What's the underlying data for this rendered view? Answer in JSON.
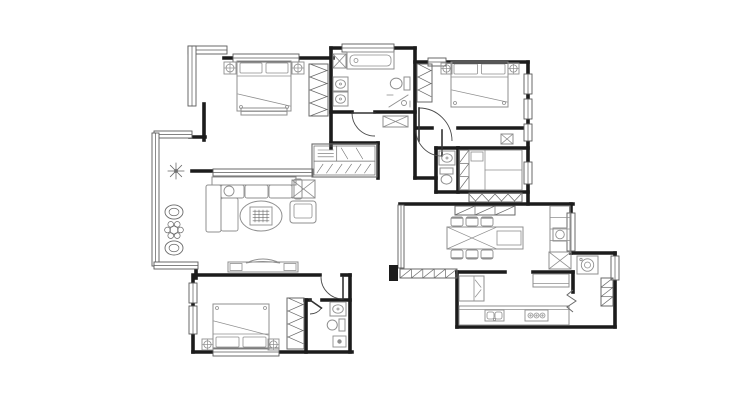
{
  "meta": {
    "canvas": {
      "w": 740,
      "h": 400
    }
  },
  "colors": {
    "bg": "#ffffff",
    "wall": "#1c1c1c",
    "furniture": "#8f8f8f",
    "thin": "#6a6a6a",
    "door": "#4a4a4a",
    "window": "#5a5a5a"
  },
  "walls": [
    [
      224,
      58,
      333,
      58
    ],
    [
      331,
      48,
      415,
      48
    ],
    [
      331,
      48,
      331,
      148
    ],
    [
      415,
      48,
      415,
      178
    ],
    [
      415,
      62,
      528,
      62
    ],
    [
      528,
      62,
      528,
      204
    ],
    [
      331,
      112,
      352,
      112
    ],
    [
      375,
      112,
      415,
      112
    ],
    [
      417,
      128,
      432,
      128
    ],
    [
      458,
      128,
      528,
      128
    ],
    [
      415,
      178,
      436,
      178
    ],
    [
      436,
      148,
      436,
      192
    ],
    [
      436,
      148,
      458,
      148
    ],
    [
      458,
      148,
      458,
      192
    ],
    [
      458,
      148,
      528,
      148
    ],
    [
      436,
      192,
      528,
      192
    ],
    [
      400,
      204,
      573,
      204
    ],
    [
      571,
      204,
      571,
      253
    ],
    [
      573,
      253,
      615,
      253
    ],
    [
      615,
      253,
      615,
      327
    ],
    [
      457,
      327,
      615,
      327
    ],
    [
      457,
      272,
      457,
      327
    ],
    [
      457,
      272,
      505,
      272
    ],
    [
      533,
      272,
      573,
      272
    ],
    [
      573,
      272,
      573,
      292
    ],
    [
      196,
      275,
      320,
      275
    ],
    [
      342,
      275,
      350,
      275
    ],
    [
      350,
      275,
      350,
      352
    ],
    [
      193,
      275,
      193,
      352
    ],
    [
      193,
      352,
      352,
      352
    ],
    [
      305,
      300,
      310,
      300
    ],
    [
      322,
      300,
      350,
      300
    ],
    [
      306,
      300,
      306,
      352
    ],
    [
      331,
      143,
      378,
      143
    ],
    [
      378,
      143,
      378,
      178
    ],
    [
      190,
      137,
      205,
      137
    ],
    [
      204,
      104,
      204,
      140
    ],
    [
      192,
      171,
      213,
      171
    ],
    [
      196,
      264,
      196,
      278
    ]
  ],
  "windows": [
    [
      233,
      54,
      66,
      8
    ],
    [
      342,
      44,
      52,
      8
    ],
    [
      428,
      58,
      18,
      8
    ],
    [
      524,
      74,
      8,
      20
    ],
    [
      524,
      99,
      8,
      20
    ],
    [
      524,
      124,
      8,
      17
    ],
    [
      524,
      162,
      8,
      22
    ],
    [
      567,
      213,
      8,
      38
    ],
    [
      611,
      256,
      8,
      24
    ],
    [
      188,
      46,
      39,
      8
    ],
    [
      188,
      46,
      8,
      60
    ],
    [
      154,
      131,
      38,
      7
    ],
    [
      152,
      133,
      7,
      133
    ],
    [
      154,
      262,
      44,
      7
    ],
    [
      189,
      283,
      8,
      20
    ],
    [
      189,
      306,
      8,
      28
    ],
    [
      213,
      348,
      66,
      8
    ],
    [
      213,
      169,
      100,
      7
    ],
    [
      398,
      205,
      6,
      63
    ]
  ],
  "doors": [
    {
      "name": "bathroom-door",
      "hx": 375,
      "hy": 113,
      "r": 23,
      "a1": 90,
      "a2": 180,
      "leaf": 180
    },
    {
      "name": "entry-door",
      "hx": 419,
      "hy": 141,
      "r": 33,
      "a1": 270,
      "a2": 360,
      "leaf": 270
    },
    {
      "name": "bedroom2-door",
      "hx": 442,
      "hy": 130,
      "r": 26,
      "a1": 90,
      "a2": 180,
      "leaf": 90
    },
    {
      "name": "bedroom3-door",
      "hx": 343,
      "hy": 277,
      "r": 22,
      "a1": 90,
      "a2": 180,
      "leaf": 90
    },
    {
      "name": "bath3-door",
      "hx": 310,
      "hy": 300,
      "r": 14,
      "a1": 35,
      "a2": 90,
      "leaf": 35
    }
  ],
  "furniture": [
    {
      "name": "master-bed",
      "type": "bed",
      "x": 237,
      "y": 61,
      "w": 54,
      "h": 50,
      "head": "top"
    },
    {
      "name": "master-nightstand-left",
      "type": "lamp",
      "x": 224,
      "y": 62,
      "s": 12
    },
    {
      "name": "master-nightstand-right",
      "type": "lamp",
      "x": 292,
      "y": 62,
      "s": 12
    },
    {
      "name": "master-bed-bench",
      "type": "counter",
      "x": 241,
      "y": 108,
      "w": 46,
      "h": 7,
      "edge": "near"
    },
    {
      "name": "master-wardrobe",
      "type": "wardrobe",
      "x": 309,
      "y": 64,
      "w": 19,
      "h": 52
    },
    {
      "name": "bath-column",
      "type": "xbox",
      "x": 333,
      "y": 54,
      "w": 13,
      "h": 14
    },
    {
      "name": "bathtub",
      "type": "tub",
      "x": 347,
      "y": 52,
      "w": 47,
      "h": 17
    },
    {
      "name": "bath-sink-1",
      "type": "sink",
      "x": 333,
      "y": 77,
      "w": 15,
      "h": 14
    },
    {
      "name": "bath-sink-2",
      "type": "sink",
      "x": 333,
      "y": 92,
      "w": 15,
      "h": 14
    },
    {
      "name": "bath-toilet",
      "type": "toilet",
      "x": 389,
      "y": 76,
      "w": 21,
      "h": 15,
      "dir": "left"
    },
    {
      "name": "bath-shower",
      "type": "shower",
      "x": 387,
      "y": 93,
      "w": 25,
      "h": 16
    },
    {
      "name": "bedroom2-bed",
      "type": "bed",
      "x": 451,
      "y": 62,
      "w": 57,
      "h": 45,
      "head": "top"
    },
    {
      "name": "bedroom2-nightstand-left",
      "type": "lamp",
      "x": 441,
      "y": 63,
      "s": 11
    },
    {
      "name": "bedroom2-nightstand-right",
      "type": "lamp",
      "x": 508,
      "y": 63,
      "s": 11
    },
    {
      "name": "bedroom2-closet",
      "type": "wardrobe",
      "x": 417,
      "y": 64,
      "w": 15,
      "h": 38
    },
    {
      "name": "hall-wall-cabinet",
      "type": "xbox",
      "x": 501,
      "y": 134,
      "w": 12,
      "h": 10
    },
    {
      "name": "entry-bench",
      "type": "xbox",
      "x": 383,
      "y": 116,
      "w": 25,
      "h": 11
    },
    {
      "name": "shoe-cabinet",
      "type": "shoecab",
      "x": 312,
      "y": 144,
      "w": 65,
      "h": 33
    },
    {
      "name": "bath2-sink",
      "type": "sink",
      "x": 439,
      "y": 151,
      "w": 16,
      "h": 14
    },
    {
      "name": "bath2-toilet",
      "type": "toilet",
      "x": 439,
      "y": 168,
      "w": 15,
      "h": 18,
      "dir": "up"
    },
    {
      "name": "study-shelf",
      "type": "hatchbox",
      "x": 459,
      "y": 150,
      "w": 10,
      "h": 40,
      "n": 3
    },
    {
      "name": "study-tatami",
      "type": "tatami",
      "x": 469,
      "y": 150,
      "w": 53,
      "h": 40
    },
    {
      "name": "study-low-cabinet",
      "type": "wardrobe",
      "x": 469,
      "y": 193,
      "w": 53,
      "h": 9
    },
    {
      "name": "dining-top-cabinet",
      "type": "hatchbox",
      "x": 455,
      "y": 206,
      "w": 60,
      "h": 9,
      "n": 3
    },
    {
      "name": "sofa",
      "type": "sofa",
      "x": 206,
      "y": 177
    },
    {
      "name": "coffee-table",
      "type": "ctable",
      "cx": 261,
      "cy": 216,
      "rx": 21,
      "ry": 15
    },
    {
      "name": "side-table",
      "type": "xbox",
      "x": 292,
      "y": 180,
      "w": 23,
      "h": 18
    },
    {
      "name": "armchair",
      "type": "armchair",
      "x": 290,
      "y": 201,
      "w": 26,
      "h": 22
    },
    {
      "name": "plant-star",
      "type": "plant",
      "cx": 176,
      "cy": 171,
      "r": 8,
      "style": "star"
    },
    {
      "name": "plant-pot-1",
      "type": "plant",
      "cx": 174,
      "cy": 212,
      "r": 9,
      "style": "pot"
    },
    {
      "name": "plant-flower",
      "type": "plant",
      "cx": 174,
      "cy": 230,
      "r": 9,
      "style": "flower"
    },
    {
      "name": "plant-pot-2",
      "type": "plant",
      "cx": 174,
      "cy": 248,
      "r": 9,
      "style": "pot"
    },
    {
      "name": "tv-console",
      "type": "tv",
      "x": 228,
      "y": 262,
      "w": 70,
      "h": 10
    },
    {
      "name": "dining-table",
      "type": "dtable",
      "x": 447,
      "y": 227,
      "w": 76,
      "h": 22
    },
    {
      "name": "chair-1",
      "type": "chair",
      "x": 451,
      "y": 217,
      "w": 12,
      "h": 9,
      "side": "top"
    },
    {
      "name": "chair-2",
      "type": "chair",
      "x": 466,
      "y": 217,
      "w": 12,
      "h": 9,
      "side": "top"
    },
    {
      "name": "chair-3",
      "type": "chair",
      "x": 481,
      "y": 217,
      "w": 12,
      "h": 9,
      "side": "top"
    },
    {
      "name": "chair-4",
      "type": "chair",
      "x": 451,
      "y": 250,
      "w": 12,
      "h": 9,
      "side": "bottom"
    },
    {
      "name": "chair-5",
      "type": "chair",
      "x": 466,
      "y": 250,
      "w": 12,
      "h": 9,
      "side": "bottom"
    },
    {
      "name": "chair-6",
      "type": "chair",
      "x": 481,
      "y": 250,
      "w": 12,
      "h": 9,
      "side": "bottom"
    },
    {
      "name": "dining-tall-cabinet",
      "type": "cabinet",
      "x": 550,
      "y": 206,
      "w": 20,
      "h": 46
    },
    {
      "name": "dining-appliance",
      "type": "circbox",
      "x": 553,
      "y": 228,
      "w": 14,
      "h": 13
    },
    {
      "name": "corner-cabinet",
      "type": "xbox",
      "x": 549,
      "y": 252,
      "w": 22,
      "h": 17
    },
    {
      "name": "washer",
      "type": "washer",
      "x": 577,
      "y": 256,
      "w": 21,
      "h": 18
    },
    {
      "name": "utility-shelf",
      "type": "hatchbox",
      "x": 601,
      "y": 278,
      "w": 12,
      "h": 28,
      "n": 3
    },
    {
      "name": "fridge",
      "type": "fridge",
      "x": 459,
      "y": 276,
      "w": 25,
      "h": 25
    },
    {
      "name": "kitchen-counter",
      "type": "counter",
      "x": 459,
      "y": 306,
      "w": 110,
      "h": 19,
      "edge": "near"
    },
    {
      "name": "kitchen-sink",
      "type": "ksink",
      "x": 485,
      "y": 310,
      "w": 19,
      "h": 11
    },
    {
      "name": "stove",
      "type": "stove",
      "x": 525,
      "y": 310,
      "w": 23,
      "h": 11
    },
    {
      "name": "kitchen-counter-2",
      "type": "counter",
      "x": 533,
      "y": 274,
      "w": 36,
      "h": 13,
      "edge": "far"
    },
    {
      "name": "bedroom3-bed",
      "type": "bed",
      "x": 213,
      "y": 304,
      "w": 56,
      "h": 45,
      "head": "bottom"
    },
    {
      "name": "bedroom3-nightstand-left",
      "type": "lamp",
      "x": 202,
      "y": 339,
      "s": 11
    },
    {
      "name": "bedroom3-nightstand-right",
      "type": "lamp",
      "x": 268,
      "y": 339,
      "s": 11
    },
    {
      "name": "bedroom3-wardrobe",
      "type": "wardrobe",
      "x": 287,
      "y": 298,
      "w": 17,
      "h": 51
    },
    {
      "name": "bath3-sink",
      "type": "sink",
      "x": 330,
      "y": 302,
      "w": 16,
      "h": 14
    },
    {
      "name": "bath3-toilet",
      "type": "toilet",
      "x": 326,
      "y": 318,
      "w": 19,
      "h": 14,
      "dir": "left"
    },
    {
      "name": "bath3-drain",
      "type": "drain",
      "x": 333,
      "y": 336,
      "w": 13,
      "h": 11
    },
    {
      "name": "kitchen-railing",
      "type": "hatchbox",
      "x": 400,
      "y": 269,
      "w": 57,
      "h": 9,
      "n": 5
    },
    {
      "name": "railing-pillar",
      "type": "stub",
      "x": 389,
      "y": 265,
      "w": 9,
      "h": 16
    },
    {
      "name": "utility-fold-door",
      "type": "zigzag",
      "pts": [
        [
          573,
          290
        ],
        [
          567,
          295
        ],
        [
          576,
          301
        ],
        [
          567,
          307
        ],
        [
          573,
          312
        ]
      ]
    }
  ]
}
